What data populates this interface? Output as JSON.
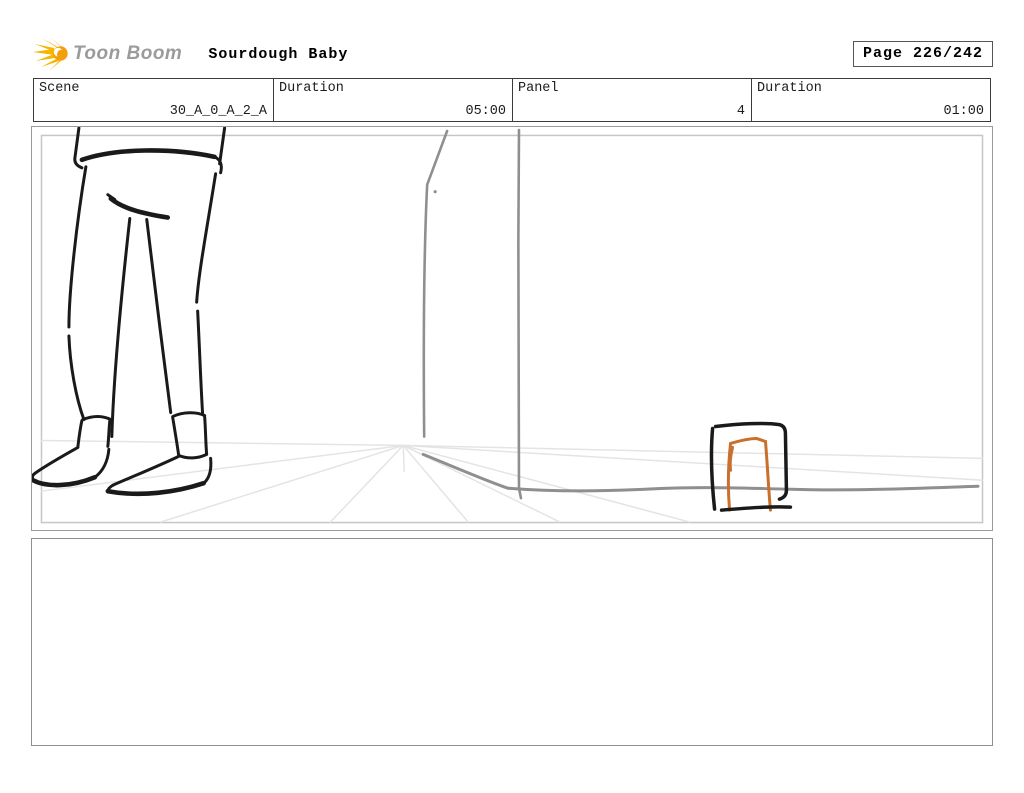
{
  "header": {
    "logo_text": "Toon Boom",
    "project_title": "Sourdough Baby",
    "page_label": "Page 226/242"
  },
  "info_table": {
    "cells": [
      {
        "label": "Scene",
        "value": "30_A_0_A_2_A"
      },
      {
        "label": "Duration",
        "value": "05:00"
      },
      {
        "label": "Panel",
        "value": "4"
      },
      {
        "label": "Duration",
        "value": "01:00"
      }
    ]
  },
  "caption_panel": {
    "text": ""
  },
  "colors": {
    "ink": "#1a1a1a",
    "wall-gray": "#8f8f8f",
    "ray-gray": "#e4e4e4",
    "accent-orange": "#c8702c",
    "logo-yellow": "#f7b500",
    "logo-head": "#f59e0b",
    "logo-gray": "#9b9b9b",
    "border-gray": "#9a9a9a",
    "inner-frame-gray": "#c6c6c6",
    "caption-border": "#8f8f8f",
    "table-border": "#3a3a3a"
  }
}
